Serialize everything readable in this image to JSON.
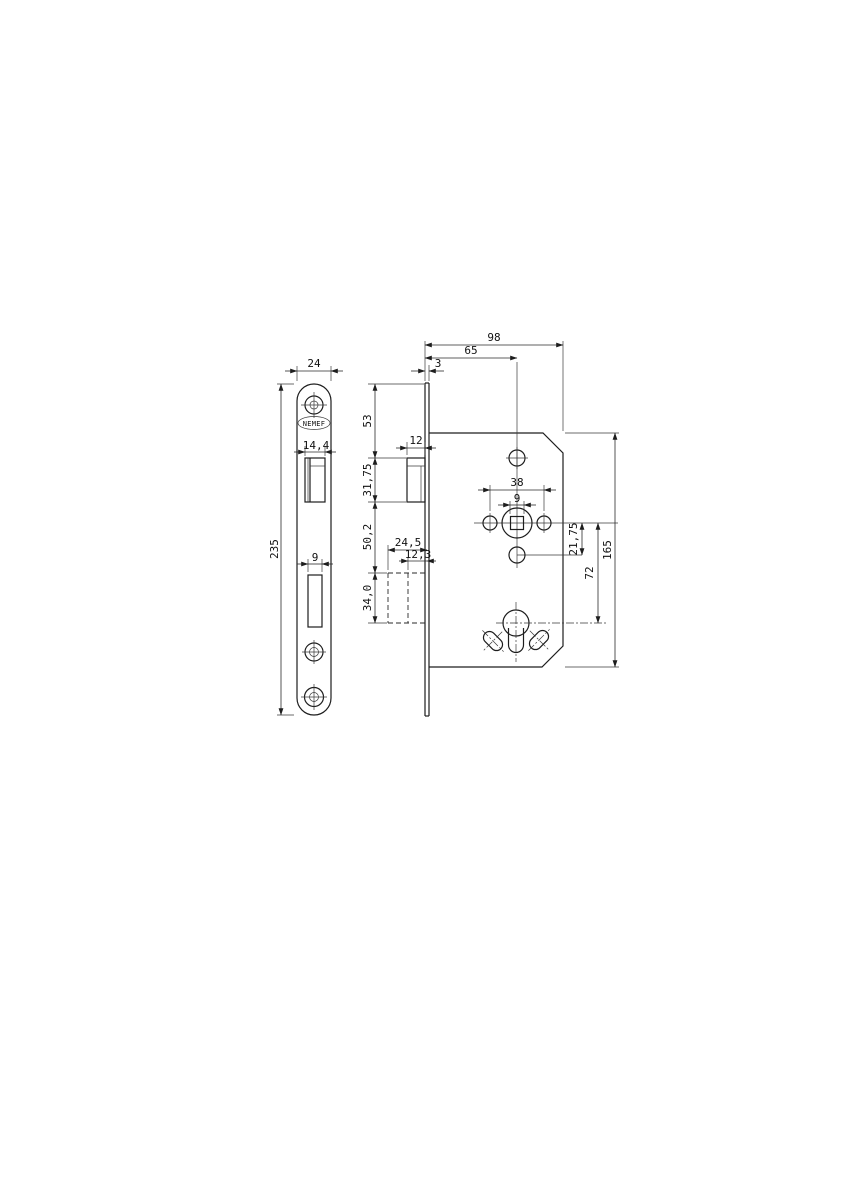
{
  "brand": "NEMEF",
  "dims": {
    "faceplate_width": "24",
    "faceplate_length": "235",
    "latch_face_width": "14,4",
    "deadbolt_slot_width": "9",
    "faceplate_thickness": "3",
    "top_to_latch": "53",
    "latch_projection": "12",
    "latch_height": "31,75",
    "latch_to_cylinder": "50,2",
    "cylinder_block_width": "24,5",
    "cylinder_inner_width": "12,3",
    "cylinder_block_height": "34,0",
    "case_depth": "98",
    "backset": "65",
    "hole_spacing": "38",
    "spindle_square": "9",
    "follower_to_hole": "21,75",
    "follower_to_cylinder": "72",
    "case_height": "165"
  }
}
